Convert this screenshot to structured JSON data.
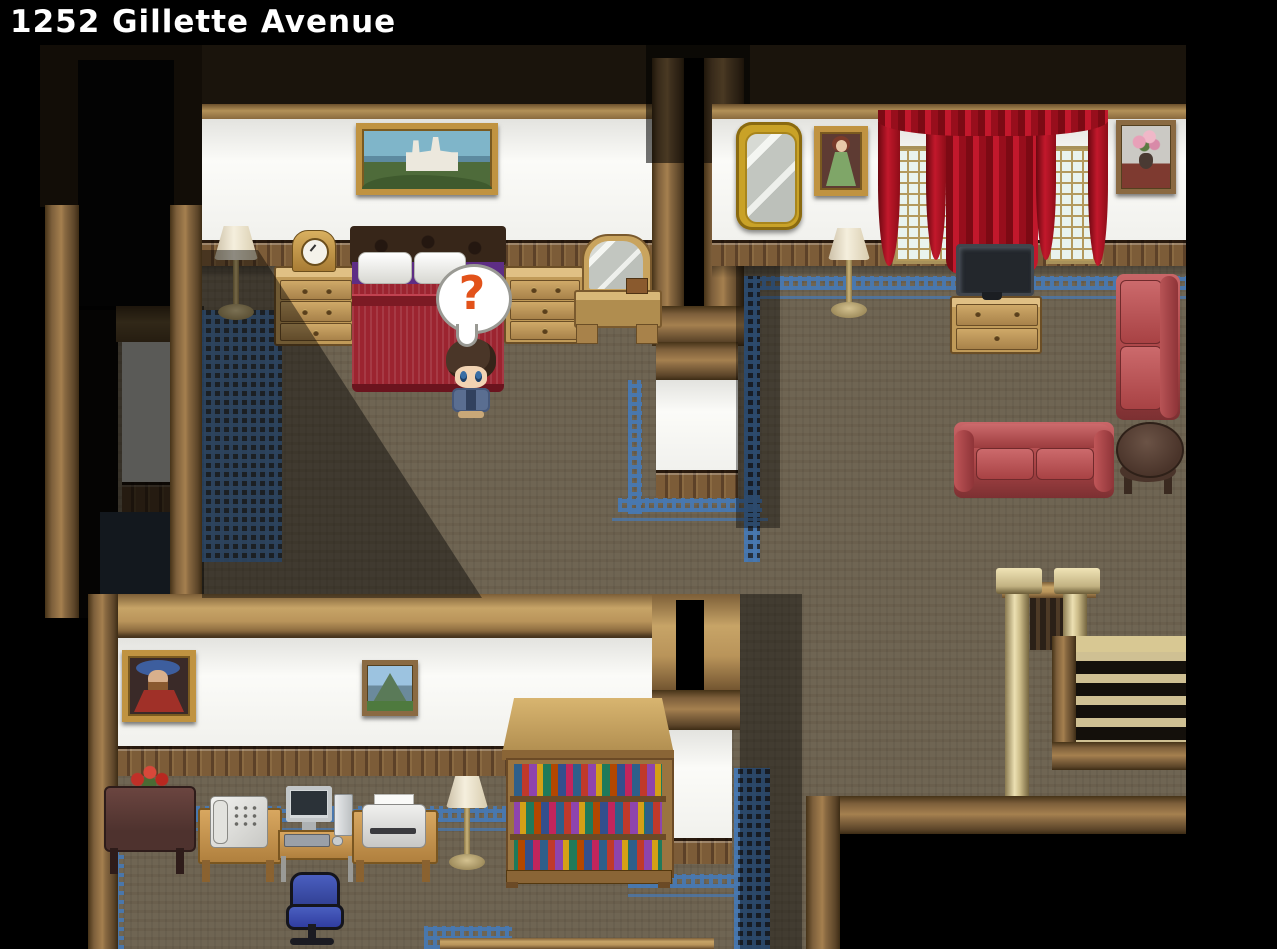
{
  "hud": {
    "location_title": "1252 Gillette Avenue"
  },
  "player": {
    "sprite": "boy-brown-hair-blue-jacket",
    "bubble_glyph": "?",
    "state": "standing-at-bed-foot"
  },
  "palette": {
    "floor_carpet": "#6f6553",
    "wall_white": "#f6f6f3",
    "wood_trim": "#a5804f",
    "wood_light": "#c7a467",
    "wainscot": "#755634",
    "carpet_border_blue": "#4878b0",
    "curtain_red": "#b01322",
    "sofa_red": "#b14a4c",
    "question_mark": "#e2521a",
    "title_text": "#ffffff",
    "void": "#000000"
  },
  "rooms": [
    {
      "id": "bedroom",
      "objects": [
        "castle-painting",
        "floor-lamp",
        "mantel-clock",
        "dresser",
        "double-bed",
        "player-character",
        "question-bubble",
        "dresser",
        "vanity-mirror",
        "blue-rug"
      ]
    },
    {
      "id": "living-room",
      "objects": [
        "ornate-wall-mirror",
        "lady-portrait-painting",
        "red-curtains",
        "lattice-window",
        "lattice-window",
        "flower-still-life-painting",
        "floor-lamp",
        "television",
        "tv-cabinet",
        "sofa-vertical",
        "sofa-horizontal",
        "round-side-table",
        "blue-carpet-border"
      ]
    },
    {
      "id": "office",
      "objects": [
        "man-portrait-painting",
        "mountain-painting",
        "flower-vase-table",
        "telephone-desk",
        "computer-desk",
        "printer-desk",
        "floor-lamp",
        "bookshelf",
        "office-chair",
        "blue-carpet-border"
      ]
    },
    {
      "id": "hallway",
      "objects": [
        "banister",
        "staircase-down",
        "wood-railing"
      ]
    }
  ]
}
